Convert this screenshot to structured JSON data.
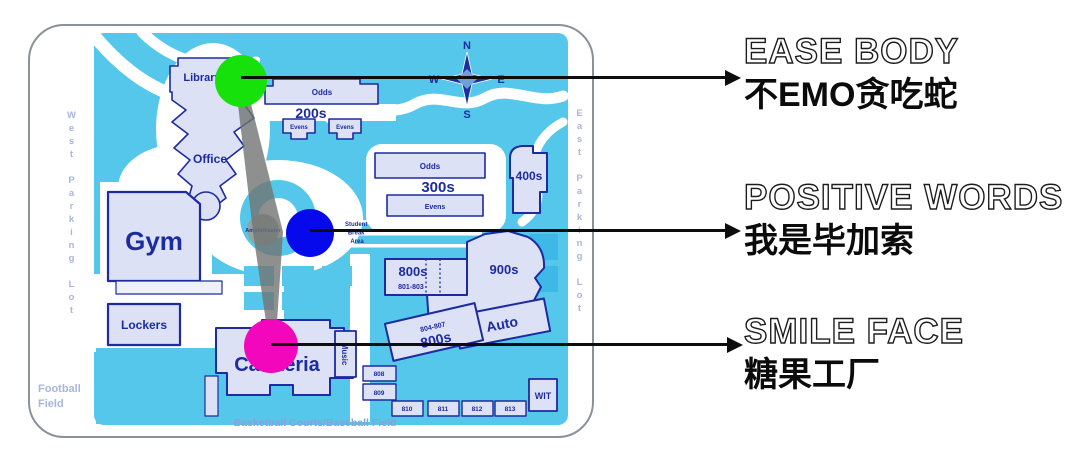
{
  "annotations": [
    {
      "title": "EASE BODY",
      "subtitle": "不EMO贪吃蛇"
    },
    {
      "title": "POSITIVE WORDS",
      "subtitle": "我是毕加索"
    },
    {
      "title": "SMILE FACE",
      "subtitle": "糖果工厂"
    }
  ],
  "markers": [
    {
      "name": "green",
      "color": "#17e10b"
    },
    {
      "name": "blue",
      "color": "#0509ec"
    },
    {
      "name": "magenta",
      "color": "#f307bd"
    }
  ],
  "compass": {
    "n": "N",
    "e": "E",
    "s": "S",
    "w": "W"
  },
  "map": {
    "area_labels": {
      "west_parking": "West Parking Lot",
      "east_parking": "East Parking Lot",
      "football_field": "Football Field",
      "basketball_baseball": "Basketball Courts/Baseball Field",
      "amphitheater": "Amphitheater",
      "student_break_1": "Student",
      "student_break_2": "Break",
      "student_break_3": "Area"
    },
    "buildings": {
      "library": "Library",
      "office": "Office",
      "gym": "Gym",
      "lockers": "Lockers",
      "cafeteria": "Cafeteria",
      "music": "Music",
      "odds_200": "Odds",
      "label_200s": "200s",
      "evens_200a": "Evens",
      "evens_200b": "Evens",
      "odds_300": "Odds",
      "label_300s": "300s",
      "evens_300": "Evens",
      "label_400s": "400s",
      "label_800s": "800s",
      "sub_800s": "801-803",
      "label_900s": "900s",
      "sub_800s_b": "804-807",
      "label_800s_b": "800s",
      "auto": "Auto",
      "b808": "808",
      "b809": "809",
      "b810": "810",
      "b811": "811",
      "b812": "812",
      "b813": "813",
      "wit": "WIT"
    },
    "colors": {
      "ground": "#55c7eb",
      "building_fill": "#dce1f6",
      "building_border": "#1d2ba0",
      "muted_label": "#a9b6dc"
    }
  }
}
